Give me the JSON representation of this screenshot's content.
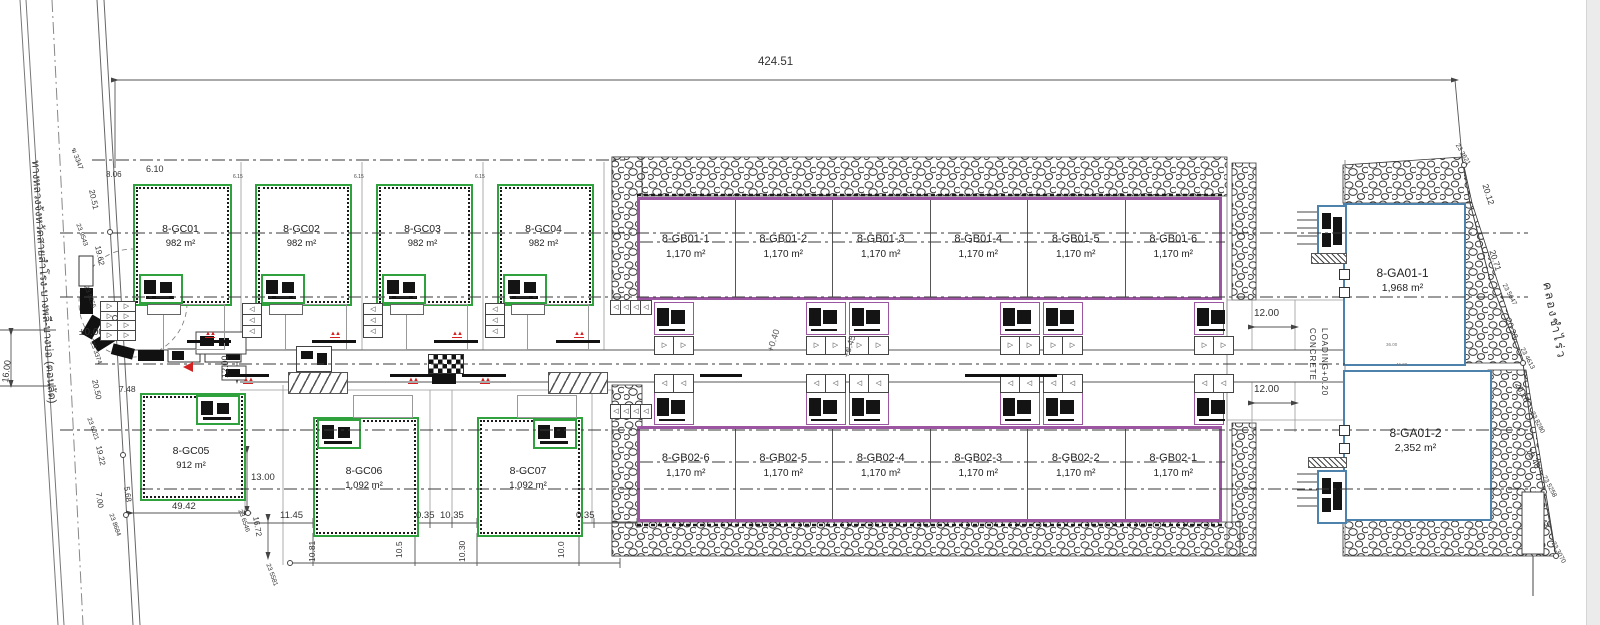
{
  "palette": {
    "green": "#2fa23e",
    "purple": "#9c55a0",
    "blue": "#4d82ad",
    "red": "#d42222",
    "line": "#444"
  },
  "units": {
    "gc": [
      {
        "id": "8-GC01",
        "area": "982 m²",
        "x": 133,
        "y": 184,
        "w": 95,
        "h": 118,
        "name_dy": 40,
        "area_dy": 55,
        "annex": "bl",
        "drive": "down"
      },
      {
        "id": "8-GC02",
        "area": "982 m²",
        "x": 255,
        "y": 184,
        "w": 93,
        "h": 118,
        "name_dy": 40,
        "area_dy": 55,
        "annex": "bl",
        "drive": "down"
      },
      {
        "id": "8-GC03",
        "area": "982 m²",
        "x": 376,
        "y": 184,
        "w": 93,
        "h": 118,
        "name_dy": 40,
        "area_dy": 55,
        "annex": "bl",
        "drive": "down"
      },
      {
        "id": "8-GC04",
        "area": "982 m²",
        "x": 497,
        "y": 184,
        "w": 93,
        "h": 118,
        "name_dy": 40,
        "area_dy": 55,
        "annex": "bl",
        "drive": "down"
      },
      {
        "id": "8-GC05",
        "area": "912 m²",
        "x": 140,
        "y": 393,
        "w": 102,
        "h": 104,
        "name_dy": 53,
        "area_dy": 68,
        "annex": "tr",
        "drive": "none"
      },
      {
        "id": "8-GC06",
        "area": "1,092 m²",
        "x": 313,
        "y": 417,
        "w": 102,
        "h": 116,
        "name_dy": 49,
        "area_dy": 64,
        "annex": "tl",
        "drive": "up"
      },
      {
        "id": "8-GC07",
        "area": "1,092 m²",
        "x": 477,
        "y": 417,
        "w": 102,
        "h": 116,
        "name_dy": 49,
        "area_dy": 64,
        "annex": "tr",
        "drive": "up"
      }
    ],
    "gb_blocks": [
      {
        "x": 637,
        "y": 197,
        "w": 585,
        "h": 103,
        "name_dy": 36,
        "area_dy": 52,
        "offices_y": 302,
        "stalls_y": 336,
        "tri": "▷",
        "office_x": [
          654,
          806,
          849,
          1000,
          1043,
          1194
        ],
        "units": [
          {
            "id": "8-GB01-1",
            "area": "1,170 m²"
          },
          {
            "id": "8-GB01-2",
            "area": "1,170 m²"
          },
          {
            "id": "8-GB01-3",
            "area": "1,170 m²"
          },
          {
            "id": "8-GB01-4",
            "area": "1,170 m²"
          },
          {
            "id": "8-GB01-5",
            "area": "1,170 m²"
          },
          {
            "id": "8-GB01-6",
            "area": "1,170 m²"
          }
        ]
      },
      {
        "x": 637,
        "y": 426,
        "w": 585,
        "h": 96,
        "name_dy": 26,
        "area_dy": 42,
        "offices_y": 392,
        "stalls_y": 374,
        "tri": "◁",
        "office_x": [
          654,
          806,
          849,
          1000,
          1043,
          1194
        ],
        "units": [
          {
            "id": "8-GB02-6",
            "area": "1,170 m²"
          },
          {
            "id": "8-GB02-5",
            "area": "1,170 m²"
          },
          {
            "id": "8-GB02-4",
            "area": "1,170 m²"
          },
          {
            "id": "8-GB02-3",
            "area": "1,170 m²"
          },
          {
            "id": "8-GB02-2",
            "area": "1,170 m²"
          },
          {
            "id": "8-GB02-1",
            "area": "1,170 m²"
          }
        ]
      }
    ],
    "ga": [
      {
        "id": "8-GA01-1",
        "area": "1,968 m²",
        "x": 1343,
        "y": 203,
        "w": 119,
        "h": 159,
        "name_dy": 64,
        "area_dy": 80
      },
      {
        "id": "8-GA01-2",
        "area": "2,352 m²",
        "x": 1343,
        "y": 370,
        "w": 145,
        "h": 147,
        "name_dy": 57,
        "area_dy": 73
      }
    ]
  },
  "ga_extra": {
    "concrete_line1": "CONCRETE",
    "concrete_line2": "LOADING+0.20"
  },
  "icons": {
    "parking_tri_right": "▷",
    "parking_tri_left": "◁",
    "hydrant_glyph": "▲▲"
  },
  "road": {
    "hydrants_top": [
      205,
      330,
      452,
      574
    ],
    "hydrants_bottom": [
      243,
      408,
      480
    ],
    "stacks": [
      242,
      363,
      485
    ],
    "bars_extra": [
      [
        700,
        42
      ],
      [
        965,
        92
      ]
    ]
  },
  "annotations": [
    {
      "t": "424.51",
      "x": 758,
      "y": 57,
      "s": 11.5
    },
    {
      "t": "8.06",
      "x": 106,
      "y": 171,
      "s": 8
    },
    {
      "t": "6.10",
      "x": 146,
      "y": 165,
      "s": 9
    },
    {
      "t": "6.15",
      "x": 233,
      "y": 175,
      "s": 5,
      "c": "#444"
    },
    {
      "t": "6.15",
      "x": 354,
      "y": 175,
      "s": 5,
      "c": "#444"
    },
    {
      "t": "6.15",
      "x": 475,
      "y": 175,
      "s": 5,
      "c": "#444"
    },
    {
      "t": "±0.00",
      "x": 79,
      "y": 328,
      "s": 10
    },
    {
      "t": "16.00",
      "x": 1,
      "y": 382,
      "s": 9,
      "r": -83
    },
    {
      "t": "12.00",
      "x": 221,
      "y": 378,
      "s": 9,
      "r": -90
    },
    {
      "t": "12.00",
      "x": 1254,
      "y": 309,
      "s": 10
    },
    {
      "t": "12.00",
      "x": 1254,
      "y": 385,
      "s": 10
    },
    {
      "t": "7.48",
      "x": 119,
      "y": 385,
      "s": 8.5
    },
    {
      "t": "13.00",
      "x": 251,
      "y": 473,
      "s": 9.5
    },
    {
      "t": "49.42",
      "x": 172,
      "y": 502,
      "s": 9.5
    },
    {
      "t": "11.45",
      "x": 280,
      "y": 511,
      "s": 9.5
    },
    {
      "t": "0.35",
      "x": 416,
      "y": 511,
      "s": 9.5
    },
    {
      "t": "10.35",
      "x": 440,
      "y": 511,
      "s": 9.5
    },
    {
      "t": "0.35",
      "x": 576,
      "y": 511,
      "s": 9.5
    },
    {
      "t": "10.81",
      "x": 308,
      "y": 562,
      "s": 8.5,
      "r": -90
    },
    {
      "t": "10.5",
      "x": 395,
      "y": 558,
      "s": 8.5,
      "r": -90
    },
    {
      "t": "10.30",
      "x": 458,
      "y": 562,
      "s": 8.5,
      "r": -90
    },
    {
      "t": "10.0",
      "x": 557,
      "y": 558,
      "s": 8.5,
      "r": -90
    },
    {
      "t": "16.72",
      "x": 259,
      "y": 516,
      "s": 8,
      "r": 80
    },
    {
      "t": "7.00",
      "x": 102,
      "y": 492,
      "s": 8,
      "r": 82
    },
    {
      "t": "5.68",
      "x": 130,
      "y": 486,
      "s": 8,
      "r": 82
    },
    {
      "t": "20.51",
      "x": 95,
      "y": 189,
      "s": 8,
      "r": 78
    },
    {
      "t": "19.62",
      "x": 101,
      "y": 245,
      "s": 8,
      "r": 78
    },
    {
      "t": "20.50",
      "x": 98,
      "y": 379,
      "s": 8,
      "r": 78
    },
    {
      "t": "19.22",
      "x": 102,
      "y": 445,
      "s": 8,
      "r": 78
    },
    {
      "t": "ฆ 3347",
      "x": 76,
      "y": 147,
      "s": 7,
      "r": 70
    },
    {
      "t": "23 9543",
      "x": 80,
      "y": 223,
      "s": 6.5,
      "r": 70
    },
    {
      "t": "23 5255",
      "x": 88,
      "y": 285,
      "s": 6.5,
      "r": 70
    },
    {
      "t": "23 3374",
      "x": 94,
      "y": 341,
      "s": 6.5,
      "r": 70
    },
    {
      "t": "23 6021",
      "x": 91,
      "y": 417,
      "s": 6.5,
      "r": 70
    },
    {
      "t": "23 8684",
      "x": 113,
      "y": 513,
      "s": 6.5,
      "r": 70
    },
    {
      "t": "23 6546",
      "x": 242,
      "y": 509,
      "s": 6.5,
      "r": 70
    },
    {
      "t": "23 5581",
      "x": 270,
      "y": 563,
      "s": 6.5,
      "r": 70
    },
    {
      "t": "+0.40",
      "x": 766,
      "y": 350,
      "s": 9,
      "r": -72,
      "c": "#555"
    },
    {
      "t": "+0.45",
      "x": 842,
      "y": 356,
      "s": 9,
      "r": -72,
      "c": "#555"
    },
    {
      "t": "23 3621",
      "x": 1459,
      "y": 143,
      "s": 6.5,
      "r": 60
    },
    {
      "t": "20.12",
      "x": 1489,
      "y": 183,
      "s": 8.5,
      "r": 72
    },
    {
      "t": "20.71",
      "x": 1496,
      "y": 249,
      "s": 8.5,
      "r": 72
    },
    {
      "t": "23 5647",
      "x": 1506,
      "y": 283,
      "s": 6.5,
      "r": 62
    },
    {
      "t": "20.33",
      "x": 1512,
      "y": 317,
      "s": 8.5,
      "r": 70
    },
    {
      "t": "23 4613",
      "x": 1524,
      "y": 347,
      "s": 6.5,
      "r": 62
    },
    {
      "t": "20.18",
      "x": 1521,
      "y": 381,
      "s": 8.5,
      "r": 62
    },
    {
      "t": "23 8280",
      "x": 1534,
      "y": 411,
      "s": 6.5,
      "r": 62
    },
    {
      "t": "19.48",
      "x": 1532,
      "y": 447,
      "s": 8.5,
      "r": 62
    },
    {
      "t": "23 5258",
      "x": 1546,
      "y": 475,
      "s": 6.5,
      "r": 62
    },
    {
      "t": "20.43",
      "x": 1541,
      "y": 507,
      "s": 8.5,
      "r": 62
    },
    {
      "t": "23 3070",
      "x": 1555,
      "y": 541,
      "s": 6.5,
      "r": 62
    },
    {
      "t": "400",
      "x": 1530,
      "y": 536,
      "s": 7,
      "r": -90
    },
    {
      "t": "36.00",
      "x": 1386,
      "y": 343,
      "s": 4.5,
      "c": "#777"
    },
    {
      "t": "46.00",
      "x": 1396,
      "y": 363,
      "s": 4.5,
      "c": "#777"
    },
    {
      "t": "ทางหลวงจังหวัดสายสำโรง-บางพลี-บางบ่อ (ตอนลัด)",
      "x": 40,
      "y": 160,
      "s": 11,
      "r": 86,
      "c": "#333"
    },
    {
      "t": "คลองชำไร่ว",
      "x": 1553,
      "y": 281,
      "s": 12,
      "r": 79,
      "c": "#333",
      "ls": 2
    }
  ]
}
